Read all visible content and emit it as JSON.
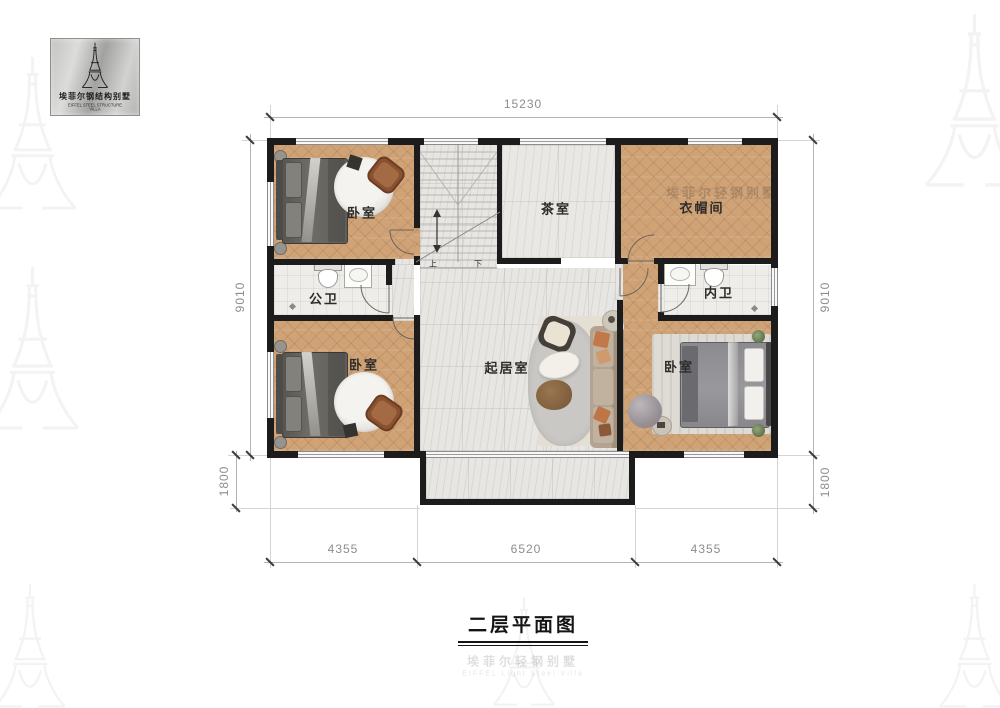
{
  "page": {
    "title": "二层平面图"
  },
  "logo": {
    "cn": "埃菲尔钢结构别墅",
    "en": "EIFFEL STEEL STRUCTURE VILLA"
  },
  "watermark": {
    "cn": "埃菲尔轻钢别墅",
    "en": "EIFFEL Light Steel Villa"
  },
  "rooms": {
    "bedroom_tl": {
      "label": "卧室"
    },
    "tea_room": {
      "label": "茶室"
    },
    "cloakroom": {
      "label": "衣帽间"
    },
    "bath_left": {
      "label": "公卫"
    },
    "bath_right": {
      "label": "内卫"
    },
    "bedroom_bl": {
      "label": "卧室"
    },
    "living": {
      "label": "起居室"
    },
    "bedroom_br": {
      "label": "卧室"
    }
  },
  "stairs": {
    "up": "上",
    "down": "下"
  },
  "dimensions": {
    "top_width": "15230",
    "left_height": "9010",
    "left_ext": "1800",
    "right_height": "9010",
    "right_ext": "1800",
    "bottom_left": "4355",
    "bottom_center": "6520",
    "bottom_right": "4355"
  },
  "colors": {
    "wall": "#1c1c1c",
    "wood": "#d0a377",
    "marble": "#e7e6e3",
    "accent": "#c2794a"
  }
}
